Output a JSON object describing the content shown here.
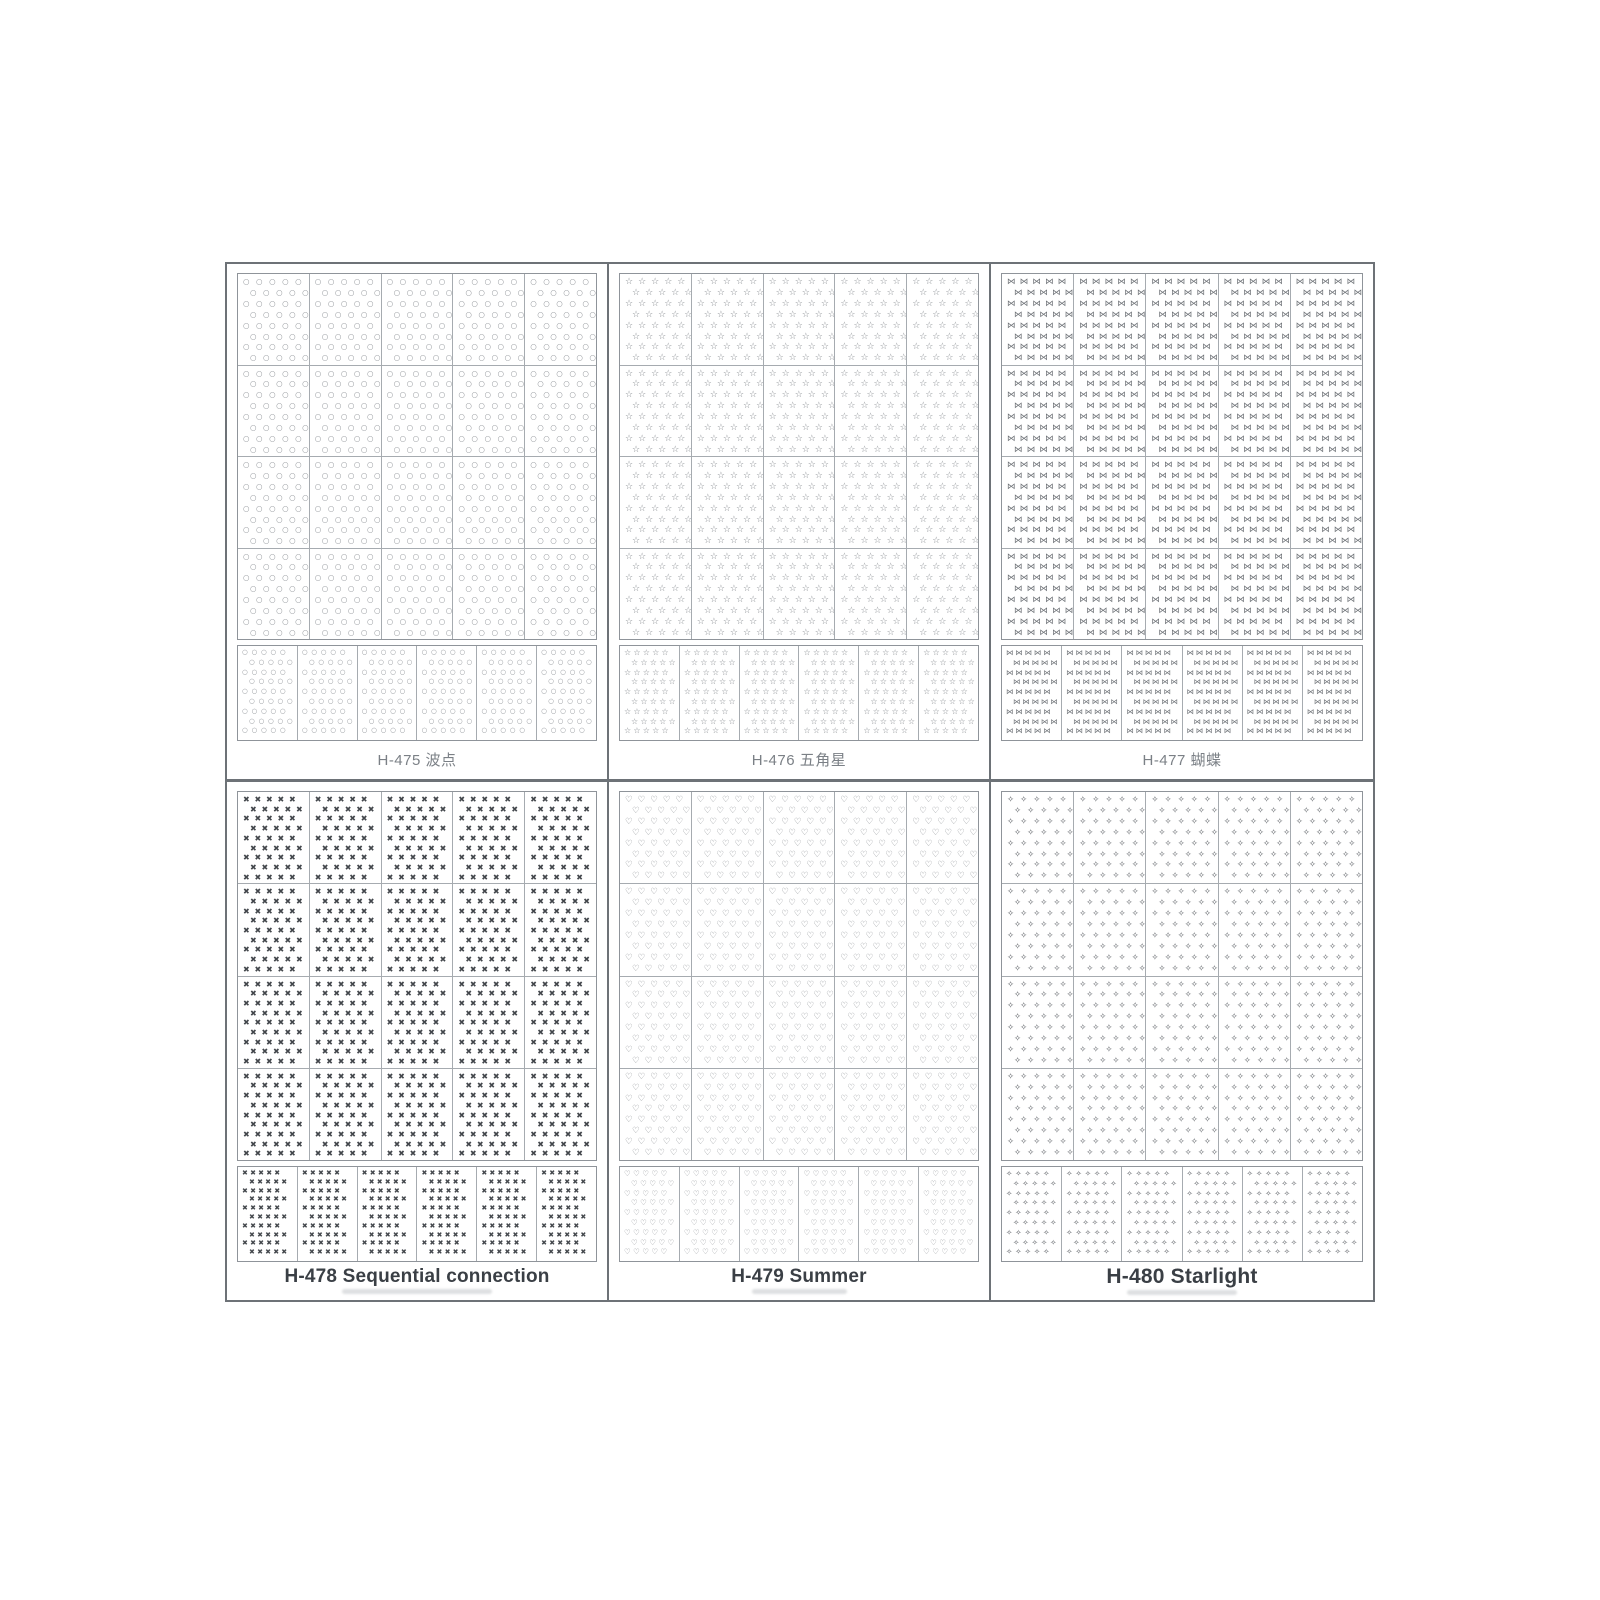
{
  "sheet": {
    "colors": {
      "background": "#ffffff",
      "outer_border": "#6d7277",
      "grid_line": "#a6abb0",
      "grid_border": "#8f949a",
      "label_regular": "#7b8086",
      "label_bold": "#3a3f45"
    },
    "layout": {
      "panel_rows": 2,
      "panel_cols": 3,
      "cell_rows": 4,
      "cell_cols": 5,
      "strip_count": 6
    },
    "panels": [
      {
        "code": "H-475",
        "label": "H-475 波点",
        "name_cn": "波点",
        "pattern": "polka-dot",
        "glyph": "○",
        "glyph_color": "#8b8f94",
        "label_weight": "regular",
        "cell_glyph_cols": 5,
        "cell_glyph_rows": 8,
        "cell_font": 7.5,
        "cell_ls": 6.5,
        "strip_glyph_cols": 5,
        "strip_glyph_rows": 9,
        "strip_font": 6.5,
        "strip_ls": 3.8
      },
      {
        "code": "H-476",
        "label": "H-476 五角星",
        "name_cn": "五角星",
        "pattern": "five-pointed-star",
        "glyph": "☆",
        "glyph_color": "#84888d",
        "label_weight": "regular",
        "cell_glyph_cols": 5,
        "cell_glyph_rows": 8,
        "cell_font": 9,
        "cell_ls": 5,
        "strip_glyph_cols": 5,
        "strip_glyph_rows": 9,
        "strip_font": 8,
        "strip_ls": 2.2
      },
      {
        "code": "H-477",
        "label": "H-477 蝴蝶",
        "name_cn": "蝴蝶",
        "pattern": "butterfly",
        "glyph": "⋈",
        "glyph_color": "#6e7277",
        "label_weight": "regular",
        "cell_glyph_cols": 5,
        "cell_glyph_rows": 8,
        "cell_font": 8.5,
        "cell_ls": 4.2,
        "strip_glyph_cols": 5,
        "strip_glyph_rows": 9,
        "strip_font": 7.5,
        "strip_ls": 1.8
      },
      {
        "code": "H-478",
        "label": "H-478 Sequential connection",
        "name_en": "Sequential connection",
        "pattern": "cross-x",
        "glyph": "✖",
        "glyph_color": "#43474c",
        "label_weight": "bold",
        "cell_glyph_cols": 5,
        "cell_glyph_rows": 9,
        "cell_font": 8,
        "cell_ls": 4.8,
        "strip_glyph_cols": 5,
        "strip_glyph_rows": 10,
        "strip_font": 7,
        "strip_ls": 2.2
      },
      {
        "code": "H-479",
        "label": "H-479 Summer",
        "name_en": "Summer",
        "pattern": "heart",
        "glyph": "♡",
        "glyph_color": "#82868b",
        "label_weight": "bold",
        "cell_glyph_cols": 5,
        "cell_glyph_rows": 8,
        "cell_font": 8.5,
        "cell_ls": 5,
        "strip_glyph_cols": 5,
        "strip_glyph_rows": 9,
        "strip_font": 7.5,
        "strip_ls": 2.4
      },
      {
        "code": "H-480",
        "label": "H-480 Starlight",
        "name_en": "Starlight",
        "pattern": "sparkle",
        "glyph": "✧",
        "glyph_color": "#5f6368",
        "label_weight": "bold-large",
        "cell_glyph_cols": 5,
        "cell_glyph_rows": 8,
        "cell_font": 8.5,
        "cell_ls": 6,
        "strip_glyph_cols": 5,
        "strip_glyph_rows": 9,
        "strip_font": 7.5,
        "strip_ls": 3
      }
    ]
  }
}
